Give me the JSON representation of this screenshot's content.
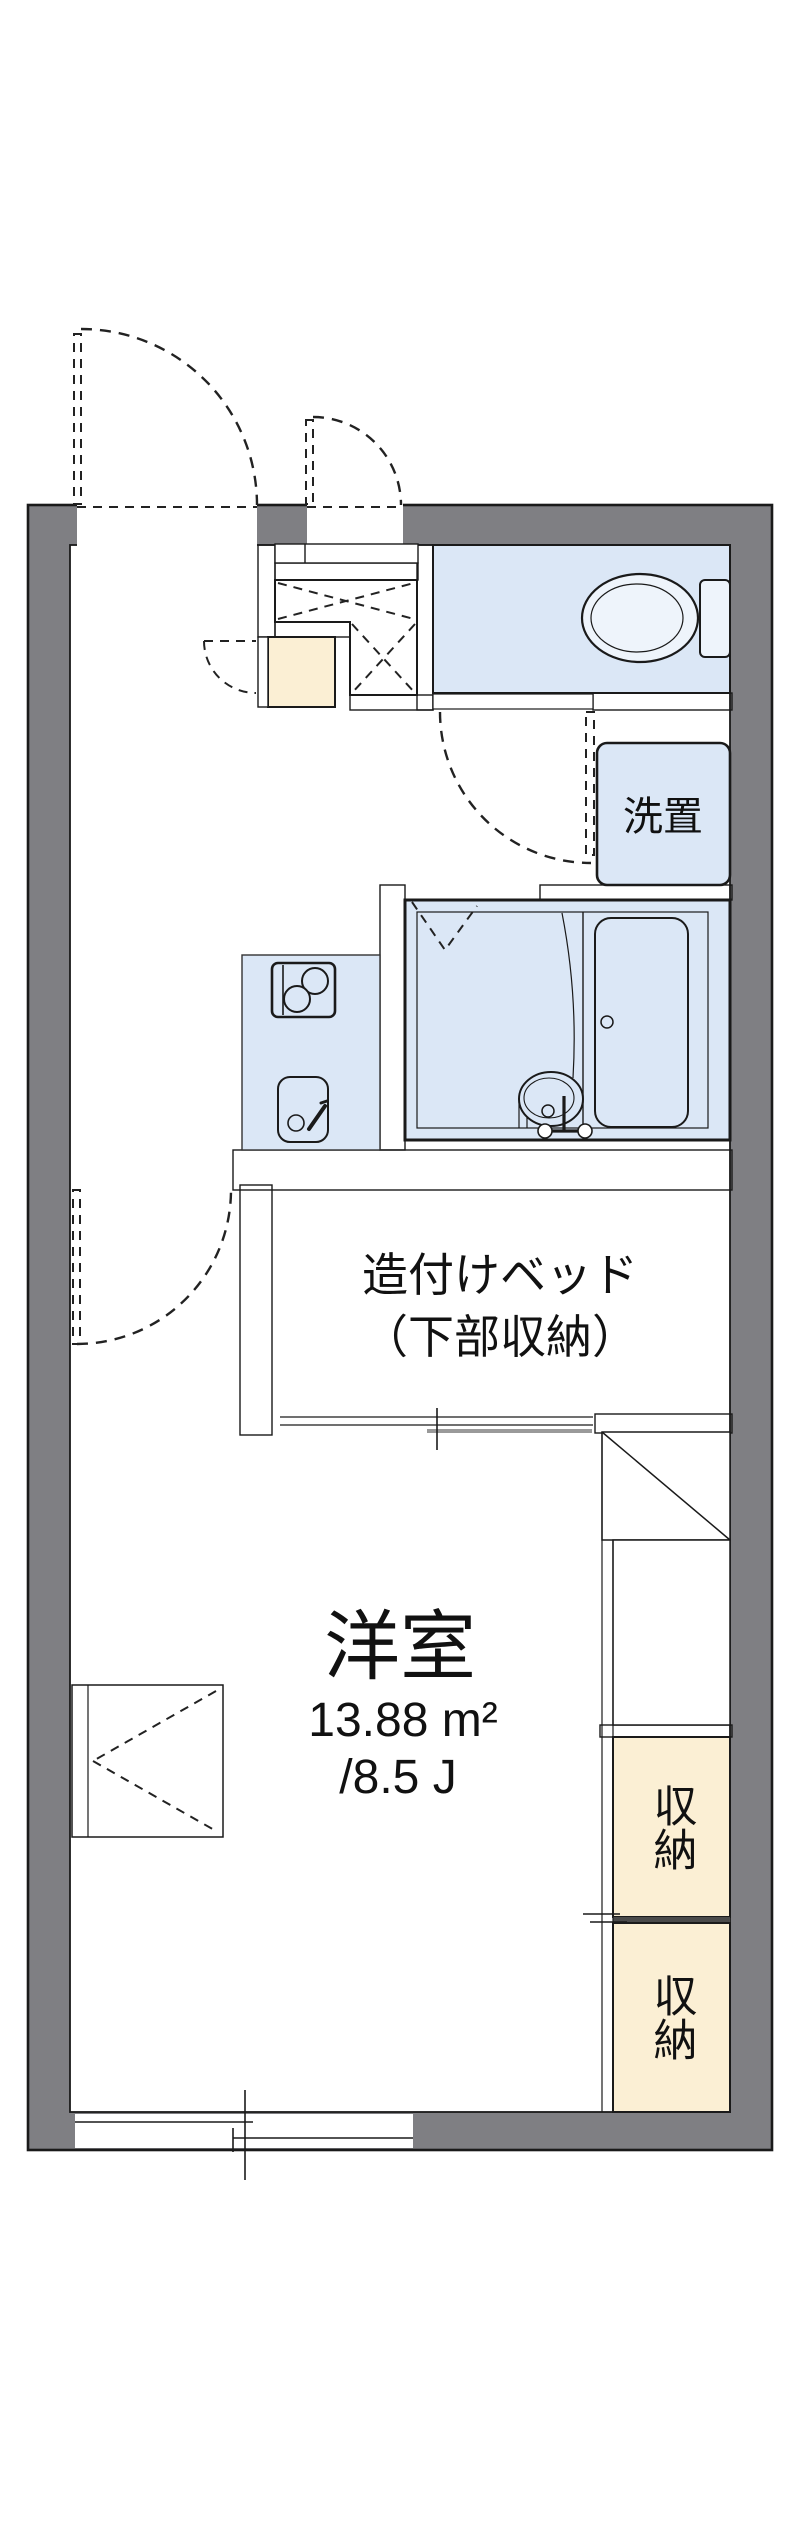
{
  "plan": {
    "rooms": {
      "western_room": {
        "name": "洋室",
        "area_m2": "13.88 m²",
        "area_tatami": "/8.5 J"
      },
      "built_in_bed": {
        "line1": "造付けベッド",
        "line2": "（下部収納）"
      },
      "laundry_space": {
        "label": "洗置"
      },
      "storage_a": {
        "label": "収納"
      },
      "storage_b": {
        "label": "収納"
      }
    },
    "colors": {
      "wall_gray": "#7f7f83",
      "water_blue": "#dbe7f6",
      "storage_cream": "#fbefd4",
      "line_black": "#1a1a1a"
    }
  }
}
